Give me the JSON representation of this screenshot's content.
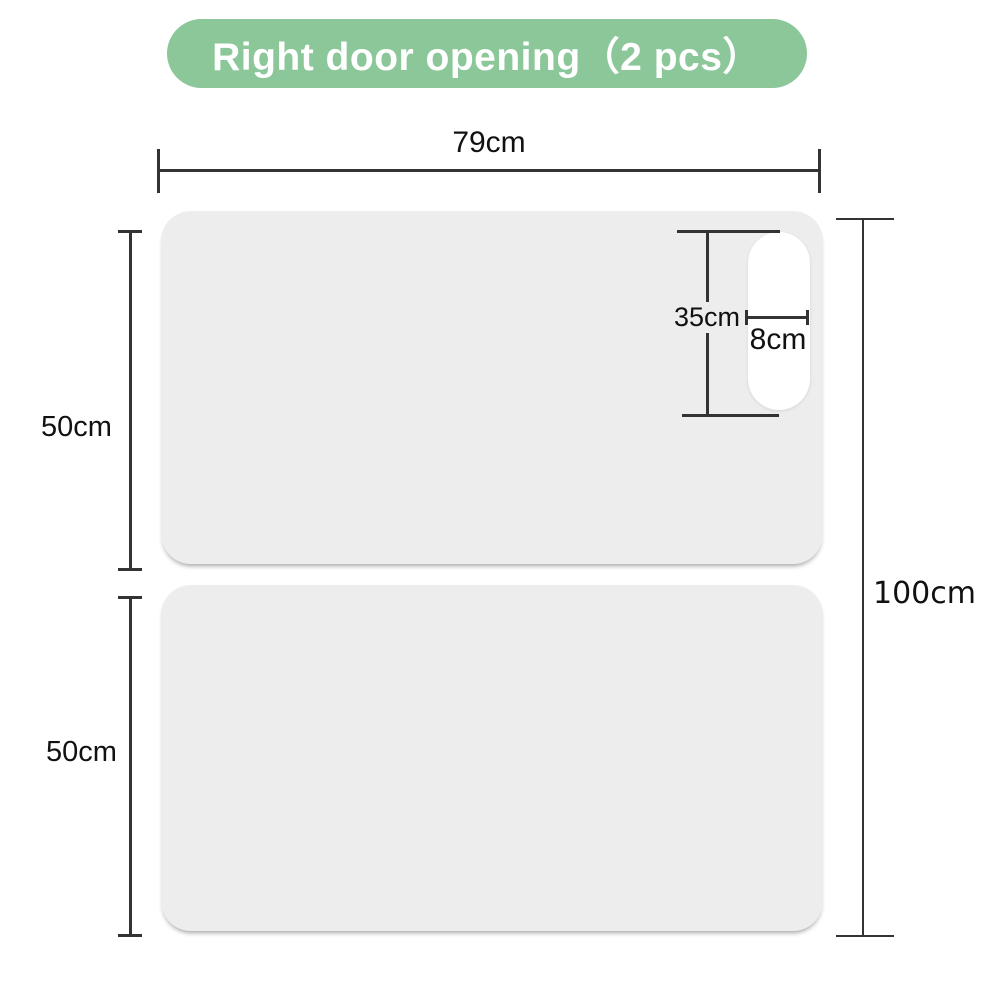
{
  "title": {
    "text": "Right door opening（2 pcs）"
  },
  "colors": {
    "accent_green": "#8CC79A",
    "panel_gray": "#EDEDED",
    "cutout_white": "#FFFFFF",
    "line": "#333333",
    "text": "#111111",
    "bg": "#FFFFFF"
  },
  "dimensions": {
    "panel_width": "79cm",
    "top_panel_height": "50cm",
    "bottom_panel_height": "50cm",
    "total_height": "100cm",
    "handle_cutout_height": "35cm",
    "handle_cutout_width": "8cm"
  }
}
